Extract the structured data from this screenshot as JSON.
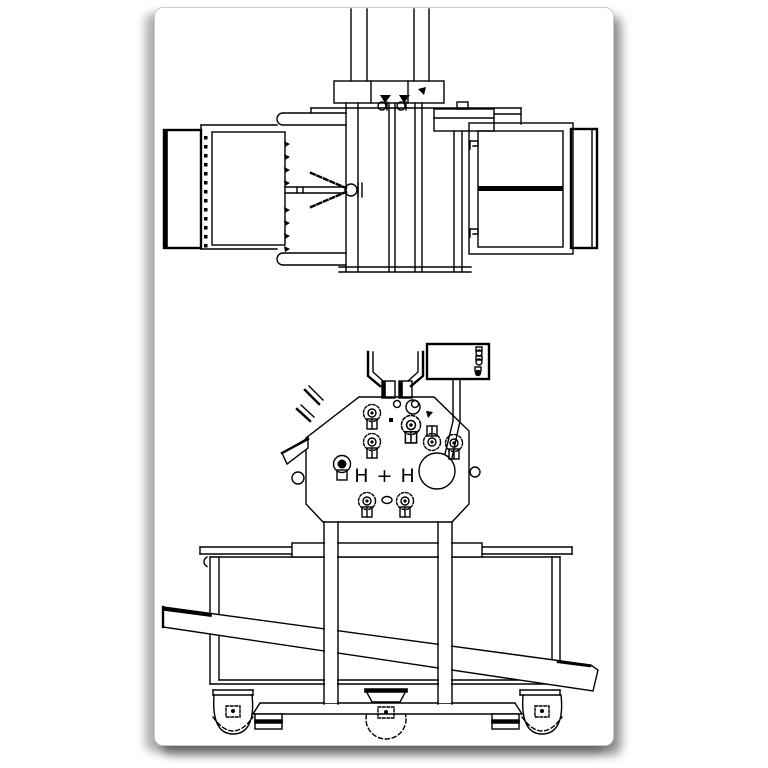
{
  "page": {
    "background_color": "#ffffff",
    "line_color": "#000000",
    "border_color": "#c9c9c9",
    "shadow_color": "#6b6b6b"
  },
  "drawing": {
    "logo_text": "H + H"
  }
}
